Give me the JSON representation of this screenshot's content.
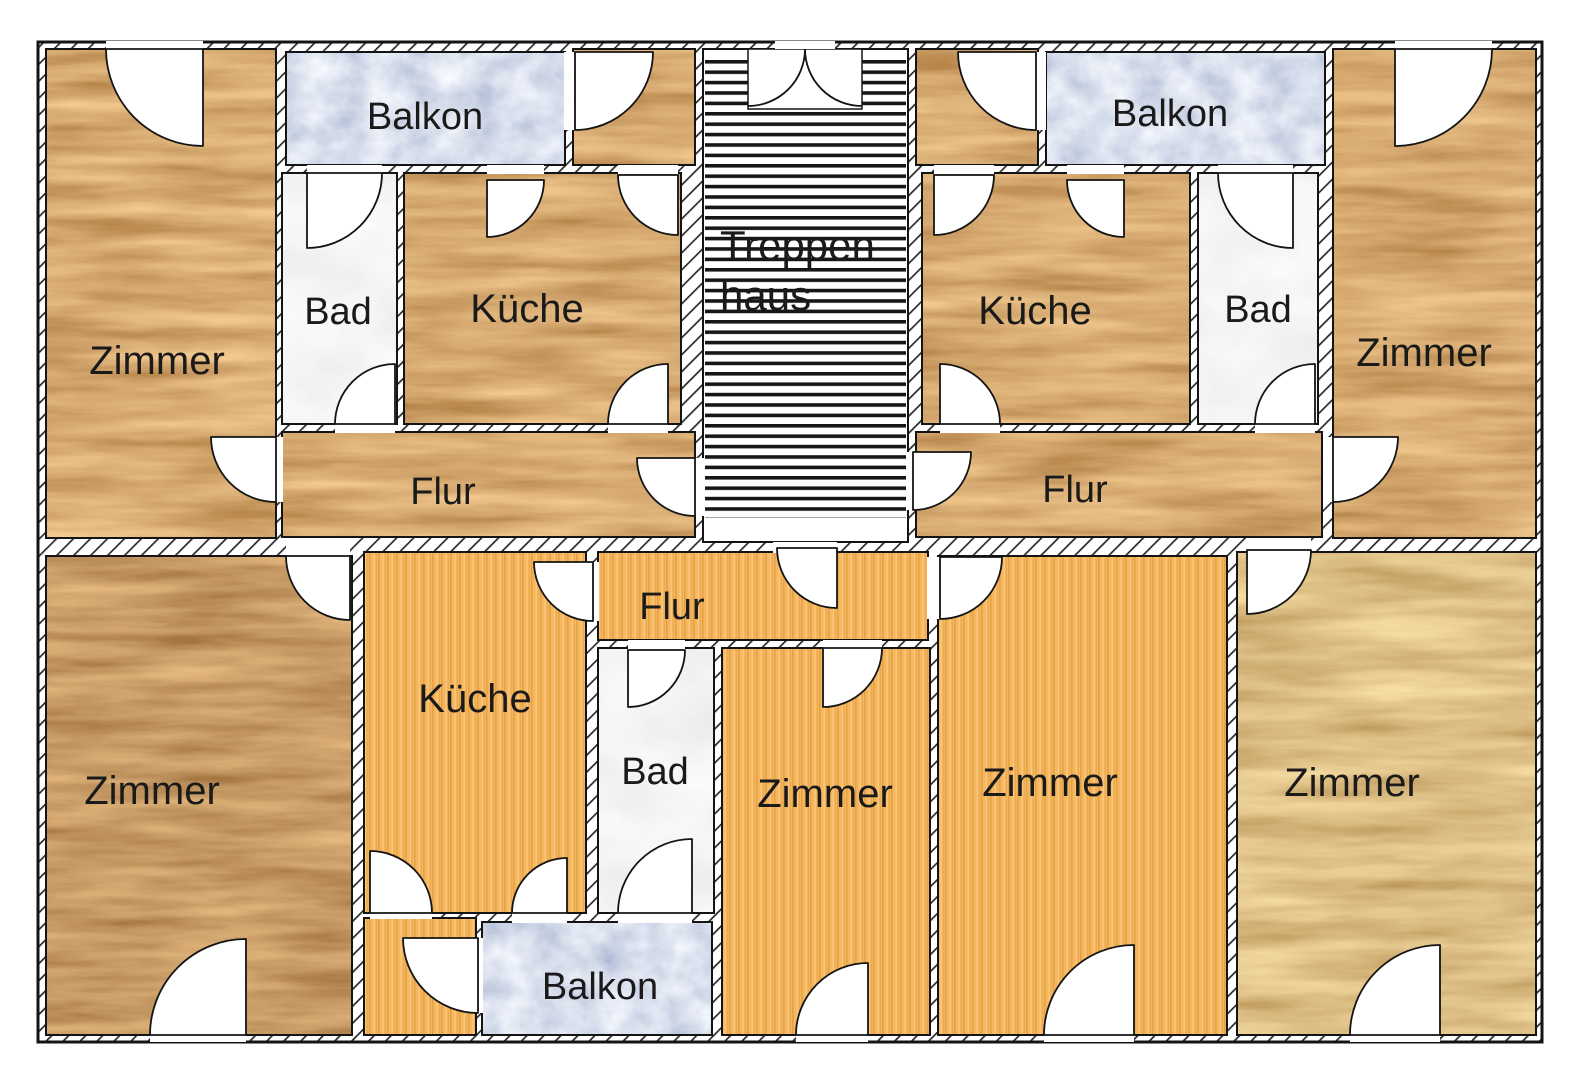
{
  "plan": {
    "type": "apartment-floor-plan",
    "language": "de"
  },
  "colors": {
    "wall": "#ffffff",
    "line": "#141414",
    "label": "#1a1a1a",
    "wood_gold": "#a9702a",
    "wood_red": "#8f5a20",
    "wood_light": "#c3913e",
    "parquet": "#f6b65e",
    "parquet_stripe_dark": "#d98f2b",
    "parquet_stripe_light": "#ffd89a",
    "balcony_blue": "#8fa7e0",
    "bath_marble": "#e9e9e9",
    "stairs_stripe": "#161616"
  },
  "rooms": {
    "tl_zimmer": {
      "label": "Zimmer"
    },
    "tl_balkon": {
      "label": "Balkon"
    },
    "tl_bad": {
      "label": "Bad"
    },
    "tl_kueche": {
      "label": "Küche"
    },
    "tl_flur": {
      "label": "Flur"
    },
    "stairs": {
      "label_line1": "Treppen",
      "label_line2": "haus"
    },
    "tr_kueche": {
      "label": "Küche"
    },
    "tr_bad": {
      "label": "Bad"
    },
    "tr_zimmer": {
      "label": "Zimmer"
    },
    "tr_balkon": {
      "label": "Balkon"
    },
    "tr_flur": {
      "label": "Flur"
    },
    "b_zimmer_left": {
      "label": "Zimmer"
    },
    "b_kueche": {
      "label": "Küche"
    },
    "b_bad": {
      "label": "Bad"
    },
    "b_flur": {
      "label": "Flur"
    },
    "b_zimmer_a": {
      "label": "Zimmer"
    },
    "b_zimmer_b": {
      "label": "Zimmer"
    },
    "b_zimmer_right": {
      "label": "Zimmer"
    },
    "b_balkon": {
      "label": "Balkon"
    }
  }
}
